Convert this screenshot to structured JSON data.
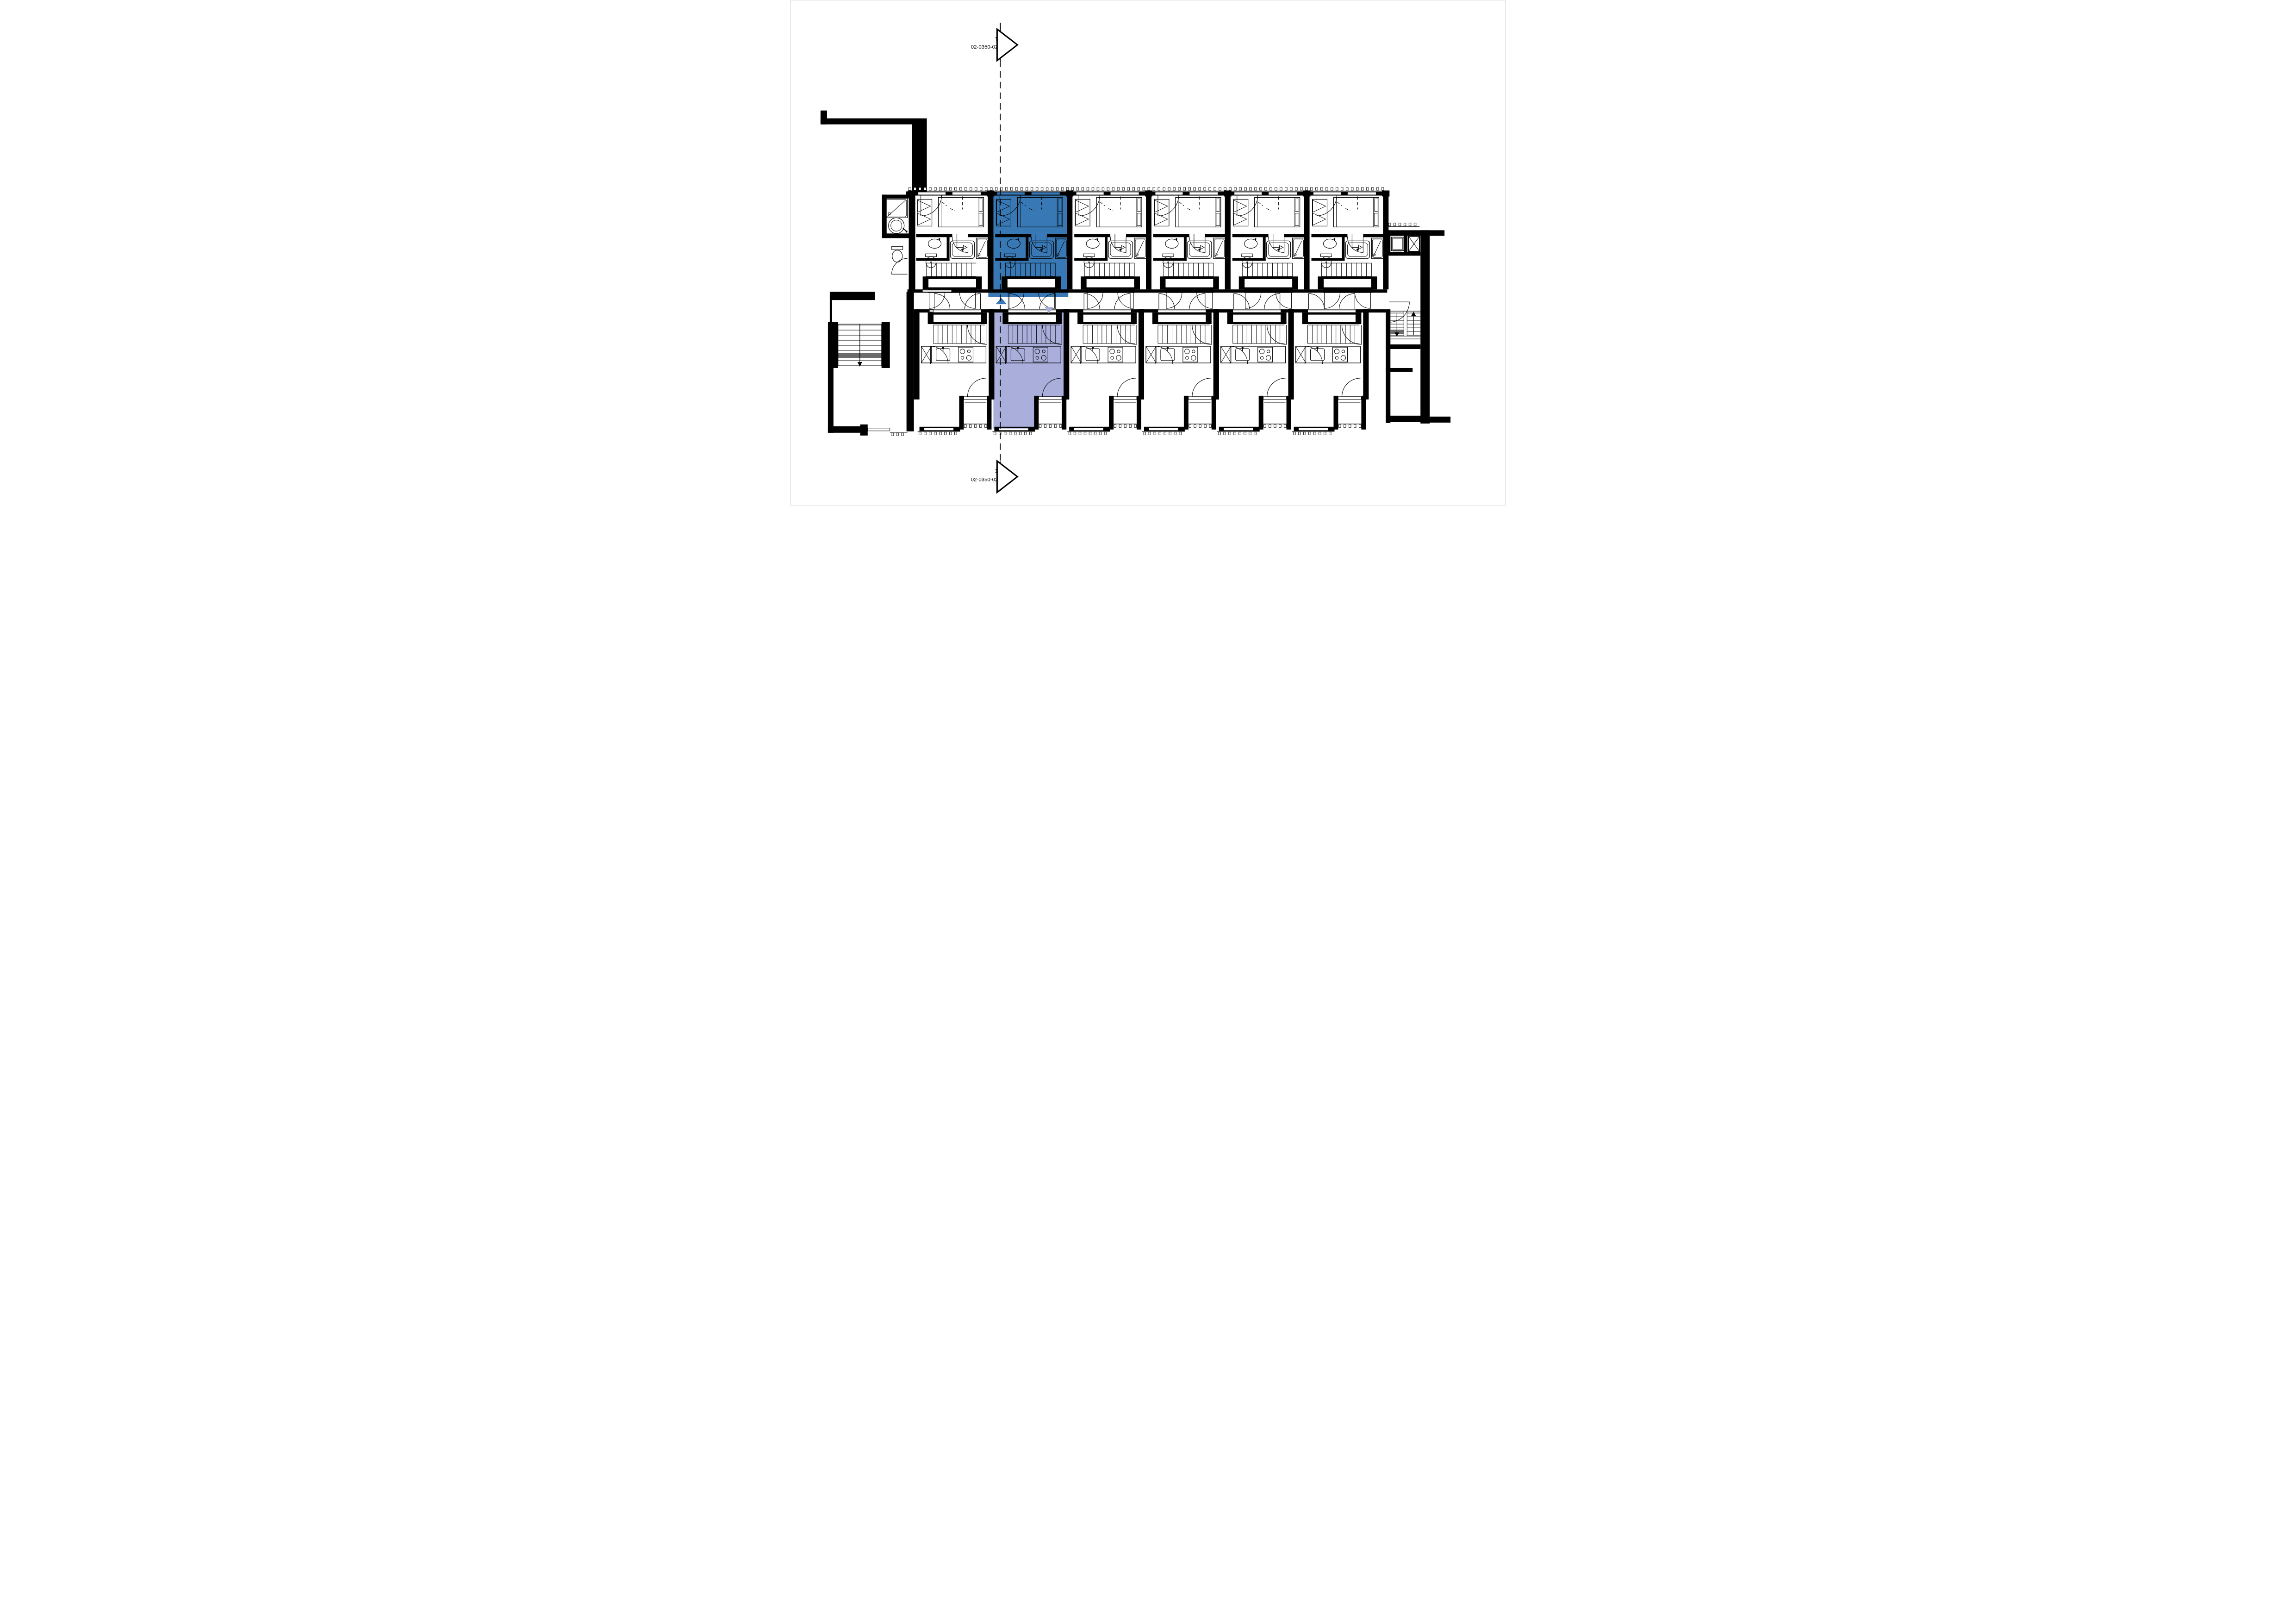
{
  "page": {
    "type": "architectural-floor-plan",
    "background": "#ffffff"
  },
  "section_markers": {
    "top": {
      "number": "1",
      "reference": "02-0350-02"
    },
    "bottom": {
      "number": "1",
      "reference": "02-0350-02"
    }
  },
  "colors": {
    "linework": "#000000",
    "background": "#ffffff",
    "upper_unit_highlight": "#3878B4",
    "lower_unit_highlight": "#A9AFDA",
    "stair_landing_gray": "#6b6b6b",
    "door_leaf_gray": "#d8d8d8"
  },
  "building": {
    "upper_row": {
      "unit_count": 6,
      "highlighted_unit": 2,
      "unit_features": [
        "double-bed",
        "wardrobe",
        "washbasin",
        "toilet",
        "bathtub",
        "shower",
        "internal-stair",
        "entry-niche",
        "corridor-doors"
      ]
    },
    "lower_row": {
      "unit_count": 6,
      "highlighted_unit": 2,
      "unit_features": [
        "entry-niche",
        "internal-stair",
        "tall-cabinet",
        "kitchen-counter",
        "kitchen-sink",
        "cooktop",
        "living-space",
        "balcony"
      ]
    },
    "corridor": {
      "direction_arrows": [
        {
          "id": "arrow-up",
          "direction": "up",
          "color_ref": "upper_unit_highlight"
        },
        {
          "id": "arrow-down",
          "direction": "down",
          "color_ref": "lower_unit_highlight"
        }
      ]
    },
    "left_wing": {
      "features": [
        "corridor-extension",
        "exit-stair-down",
        "shower",
        "round-washbasin",
        "toilet"
      ]
    },
    "right_wing": {
      "features": [
        "laundry-room",
        "elevator-shaft",
        "double-flight-stair",
        "lobby"
      ]
    }
  }
}
